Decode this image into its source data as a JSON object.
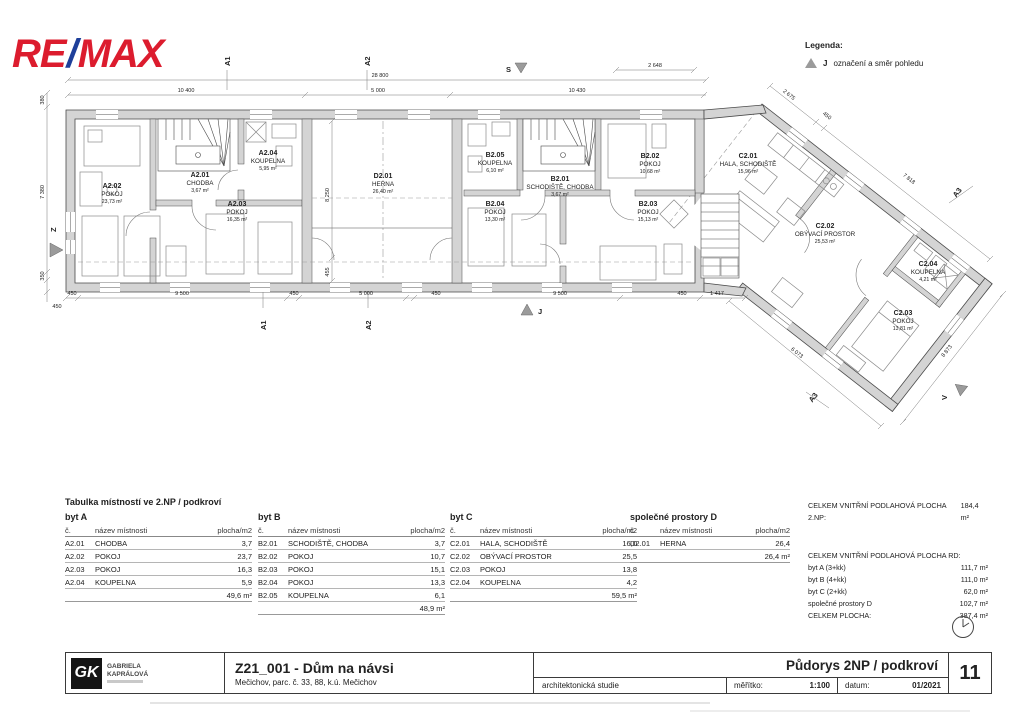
{
  "colors": {
    "remax_red": "#dc1c2e",
    "remax_blue": "#1e3f9a",
    "wall_gray": "#d4d4d4",
    "marker_gray": "#9b9b9b"
  },
  "logo": {
    "re": "RE",
    "slash": "/",
    "max": "MAX"
  },
  "legend": {
    "title": "Legenda:",
    "symbol": "J",
    "text": "označení a směr pohledu"
  },
  "plan": {
    "rooms": {
      "a201": {
        "code": "A2.01",
        "name": "CHODBA",
        "area": "3,67 m²"
      },
      "a202": {
        "code": "A2.02",
        "name": "POKOJ",
        "area": "23,73 m²"
      },
      "a203": {
        "code": "A2.03",
        "name": "POKOJ",
        "area": "16,35 m²"
      },
      "a204": {
        "code": "A2.04",
        "name": "KOUPELNA",
        "area": "5,95 m²"
      },
      "d201": {
        "code": "D2.01",
        "name": "HERNA",
        "area": "26,40 m²"
      },
      "b201": {
        "code": "B2.01",
        "name": "SCHODIŠTĚ, CHODBA",
        "area": "3,67 m²"
      },
      "b202": {
        "code": "B2.02",
        "name": "POKOJ",
        "area": "10,68 m²"
      },
      "b203": {
        "code": "B2.03",
        "name": "POKOJ",
        "area": "15,13 m²"
      },
      "b204": {
        "code": "B2.04",
        "name": "POKOJ",
        "area": "13,30 m²"
      },
      "b205": {
        "code": "B2.05",
        "name": "KOUPELNA",
        "area": "6,10 m²"
      },
      "c201": {
        "code": "C2.01",
        "name": "HALA, SCHODIŠTĚ",
        "area": "15,96 m²"
      },
      "c202": {
        "code": "C2.02",
        "name": "OBÝVACÍ PROSTOR",
        "area": "25,53 m²"
      },
      "c203": {
        "code": "C2.03",
        "name": "POKOJ",
        "area": "13,81 m²"
      },
      "c204": {
        "code": "C2.04",
        "name": "KOUPELNA",
        "area": "4,21 m²"
      }
    },
    "markers": {
      "a1": "A1",
      "a2": "A2",
      "a3": "A3",
      "s": "S",
      "j": "J",
      "z": "Z",
      "v": "V"
    },
    "dims": {
      "top_total": "28 800",
      "top_left": "10 400",
      "top_mid": "5 000",
      "top_right": "10 430",
      "top_wing": "2 648",
      "left_top": "380",
      "left_main": "7 380",
      "left_bottom": "350",
      "left_corner": "450",
      "bottom": [
        "450",
        "9 500",
        "450",
        "5 000",
        "450",
        "9 500",
        "450",
        "1 417"
      ],
      "wing_ne": [
        "2 675",
        "450",
        "7 818"
      ],
      "wing_sw": "6 073",
      "wing_end": "8 873",
      "herna_h": "8 250",
      "herna_h2": "455"
    }
  },
  "tables": [
    {
      "title": "Tabulka místností ve 2.NP / podkroví",
      "subtitle": "byt A",
      "col_no": "č.",
      "col_name": "název místnosti",
      "col_area": "plocha/m2",
      "rows": [
        [
          "A2.01",
          "CHODBA",
          "3,7"
        ],
        [
          "A2.02",
          "POKOJ",
          "23,7"
        ],
        [
          "A2.03",
          "POKOJ",
          "16,3"
        ],
        [
          "A2.04",
          "KOUPELNA",
          "5,9"
        ]
      ],
      "total": "49,6 m²"
    },
    {
      "title": "",
      "subtitle": "byt B",
      "col_no": "č.",
      "col_name": "název místnosti",
      "col_area": "plocha/m2",
      "rows": [
        [
          "B2.01",
          "SCHODIŠTĚ, CHODBA",
          "3,7"
        ],
        [
          "B2.02",
          "POKOJ",
          "10,7"
        ],
        [
          "B2.03",
          "POKOJ",
          "15,1"
        ],
        [
          "B2.04",
          "POKOJ",
          "13,3"
        ],
        [
          "B2.05",
          "KOUPELNA",
          "6,1"
        ]
      ],
      "total": "48,9 m²"
    },
    {
      "title": "",
      "subtitle": "byt C",
      "col_no": "č.",
      "col_name": "název místnosti",
      "col_area": "plocha/m2",
      "rows": [
        [
          "C2.01",
          "HALA, SCHODIŠTĚ",
          "16,0"
        ],
        [
          "C2.02",
          "OBÝVACÍ PROSTOR",
          "25,5"
        ],
        [
          "C2.03",
          "POKOJ",
          "13,8"
        ],
        [
          "C2.04",
          "KOUPELNA",
          "4,2"
        ]
      ],
      "total": "59,5 m²"
    },
    {
      "title": "",
      "subtitle": "společné prostory D",
      "col_no": "č.",
      "col_name": "název místnosti",
      "col_area": "plocha/m2",
      "rows": [
        [
          "D2.01",
          "HERNA",
          "26,4"
        ]
      ],
      "total": "26,4 m²"
    }
  ],
  "summary": {
    "line1_label": "CELKEM VNITŘNÍ PODLAHOVÁ PLOCHA 2.NP:",
    "line1_value": "184,4 m²",
    "heading": "CELKEM VNITŘNÍ PODLAHOVÁ PLOCHA RD:",
    "rows": [
      [
        "byt A (3+kk)",
        "111,7 m²"
      ],
      [
        "byt B (4+kk)",
        "111,0 m²"
      ],
      [
        "byt C (2+kk)",
        "62,0 m²"
      ],
      [
        "společné prostory D",
        "102,7 m²"
      ],
      [
        "CELKEM PLOCHA:",
        "387,4 m²"
      ]
    ]
  },
  "titleblock": {
    "firm_initials": "GK",
    "firm_line1": "GABRIELA",
    "firm_line2": "KAPRÁLOVÁ",
    "project": "Z21_001 - Dům na návsi",
    "location": "Mečichov, parc. č. 33, 88, k.ú. Mečichov",
    "phase": "architektonická studie",
    "drawing": "Půdorys 2NP / podkroví",
    "scale_label": "měřítko:",
    "scale": "1:100",
    "date_label": "datum:",
    "date": "01/2021",
    "sheet": "11"
  }
}
